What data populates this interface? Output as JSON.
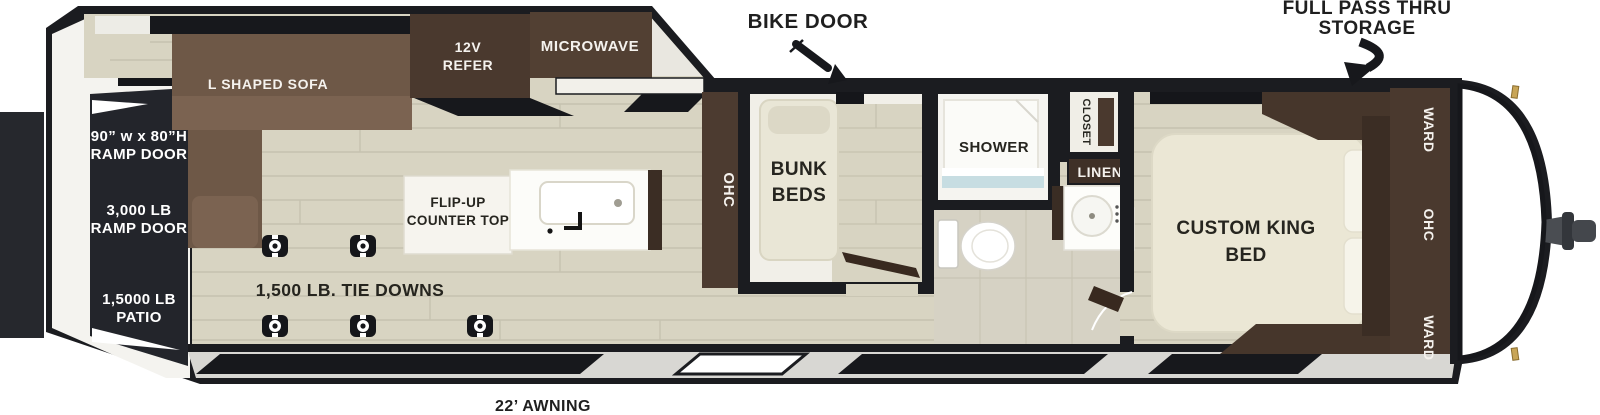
{
  "callouts": {
    "bike_door": "BIKE DOOR",
    "full_pass_thru_line1": "FULL PASS THRU",
    "full_pass_thru_line2": "STORAGE",
    "awning": "22’ AWNING"
  },
  "rear": {
    "ramp_size_line1": "90” w x 80”H",
    "ramp_size_line2": "RAMP DOOR",
    "ramp_weight_line1": "3,000 LB",
    "ramp_weight_line2": "RAMP DOOR",
    "patio_line1": "1,5000 LB",
    "patio_line2": "PATIO"
  },
  "garage": {
    "tie_downs": "1,500 LB. TIE DOWNS",
    "sofa": "L SHAPED SOFA",
    "refer_line1": "12V",
    "refer_line2": "REFER",
    "microwave": "MICROWAVE",
    "counter_line1": "FLIP-UP",
    "counter_line2": "COUNTER TOP",
    "ohc": "OHC"
  },
  "bunk_room": {
    "line1": "BUNK",
    "line2": "BEDS"
  },
  "bathroom": {
    "shower": "SHOWER",
    "closet": "CLOSET",
    "linen": "LINEN"
  },
  "bedroom": {
    "bed_line1": "CUSTOM KING",
    "bed_line2": "BED",
    "ward_front": "WARD",
    "ohc": "OHC",
    "ward_rear": "WARD"
  },
  "colors": {
    "outline": "#1b1c20",
    "floor": "#d8d4c2",
    "cabinet_dark": "#4a392e",
    "sofa_brown": "#6e5847",
    "ramp_panel_dark": "#23252b"
  }
}
